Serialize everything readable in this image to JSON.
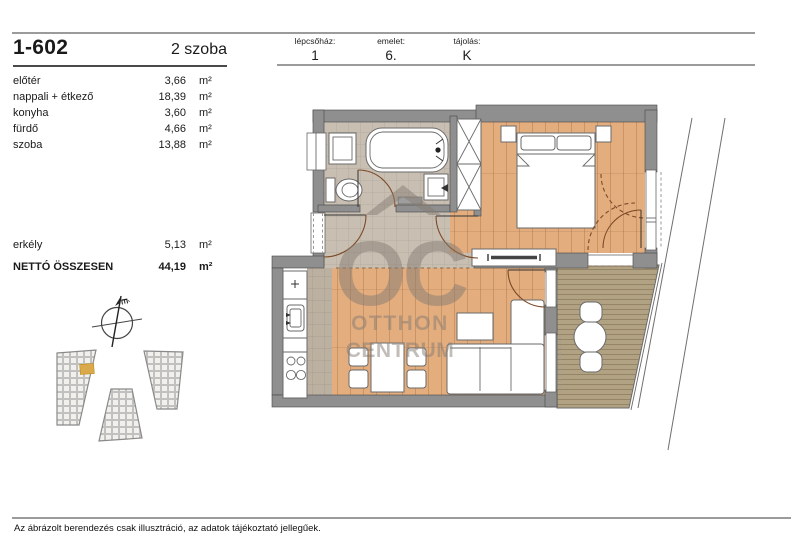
{
  "page": {
    "unit_id": "1-602",
    "room_count": "2 szoba",
    "disclaimer": "Az ábrázolt berendezés csak illusztráció, az adatok tájékoztató jellegűek."
  },
  "header": {
    "columns": [
      {
        "label": "lépcsőház:",
        "value": "1"
      },
      {
        "label": "emelet:",
        "value": "6."
      },
      {
        "label": "tájolás:",
        "value": "K"
      }
    ]
  },
  "area_table": {
    "rooms": [
      {
        "name": "előtér",
        "area": "3,66",
        "unit": "m²"
      },
      {
        "name": "nappali + étkező",
        "area": "18,39",
        "unit": "m²"
      },
      {
        "name": "konyha",
        "area": "3,60",
        "unit": "m²"
      },
      {
        "name": "fürdő",
        "area": "4,66",
        "unit": "m²"
      },
      {
        "name": "szoba",
        "area": "13,88",
        "unit": "m²"
      }
    ],
    "balcony": {
      "name": "erkély",
      "area": "5,13",
      "unit": "m²"
    },
    "total": {
      "name": "NETTÓ ÖSSZESEN",
      "area": "44,19",
      "unit": "m²"
    }
  },
  "floor_plan": {
    "watermark": {
      "line1": "OC",
      "line2": "OTTHON",
      "line3": "CENTRUM"
    },
    "compass_label": "É"
  },
  "colors": {
    "wall": "#8f8f8f",
    "wood-floor": "#e3ad7e",
    "tile-floor": "#c8bfb2",
    "kitchen-tile": "#bcb1a1",
    "deck-floor": "#b2a284",
    "unit-highlight": "#d9a94c",
    "watermark": "#877d73"
  }
}
